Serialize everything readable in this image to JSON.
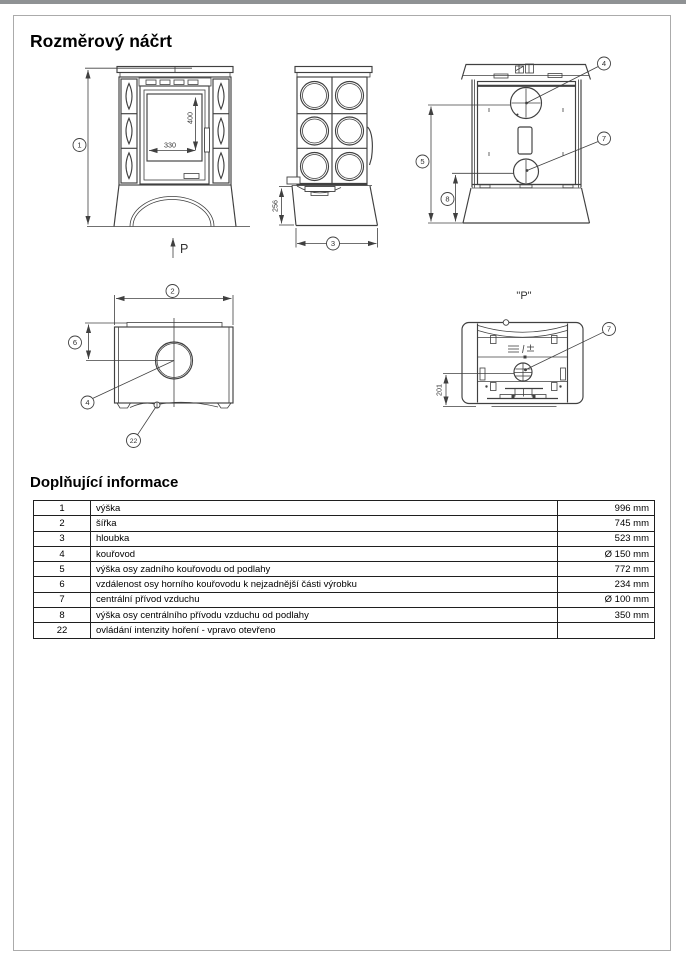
{
  "page": {
    "title": "Rozměrový náčrt",
    "section_title": "Doplňující informace"
  },
  "drawing": {
    "front_view": {
      "height_callout": "1",
      "door_width_dim": "330",
      "door_height_dim": "400",
      "push_direction_label": "P"
    },
    "side_view": {
      "base_height_dim": "256",
      "depth_callout": "3"
    },
    "back_view": {
      "flue_callout": "4",
      "air_inlet_callout": "7",
      "flue_height_callout": "5",
      "air_height_callout": "8"
    },
    "top_view": {
      "width_callout": "2",
      "flue_offset_callout": "6",
      "flue_callout": "4",
      "control_callout": "22"
    },
    "bottom_view": {
      "view_label": "\"P\"",
      "air_inlet_callout": "7",
      "air_distance_dim": "201"
    }
  },
  "table": {
    "rows": [
      {
        "num": "1",
        "label": "výška",
        "value": "996 mm"
      },
      {
        "num": "2",
        "label": "šířka",
        "value": "745 mm"
      },
      {
        "num": "3",
        "label": "hloubka",
        "value": "523 mm"
      },
      {
        "num": "4",
        "label": "kouřovod",
        "value": "Ø 150 mm"
      },
      {
        "num": "5",
        "label": "výška osy zadního kouřovodu od podlahy",
        "value": "772 mm"
      },
      {
        "num": "6",
        "label": "vzdálenost osy horního kouřovodu k nejzadnější části výrobku",
        "value": "234 mm"
      },
      {
        "num": "7",
        "label": "centrální přívod vzduchu",
        "value": "Ø 100 mm"
      },
      {
        "num": "8",
        "label": "výška osy centrálního přívodu vzduchu od podlahy",
        "value": "350 mm"
      },
      {
        "num": "22",
        "label": "ovládání intenzity hoření - vpravo otevřeno",
        "value": ""
      }
    ]
  }
}
